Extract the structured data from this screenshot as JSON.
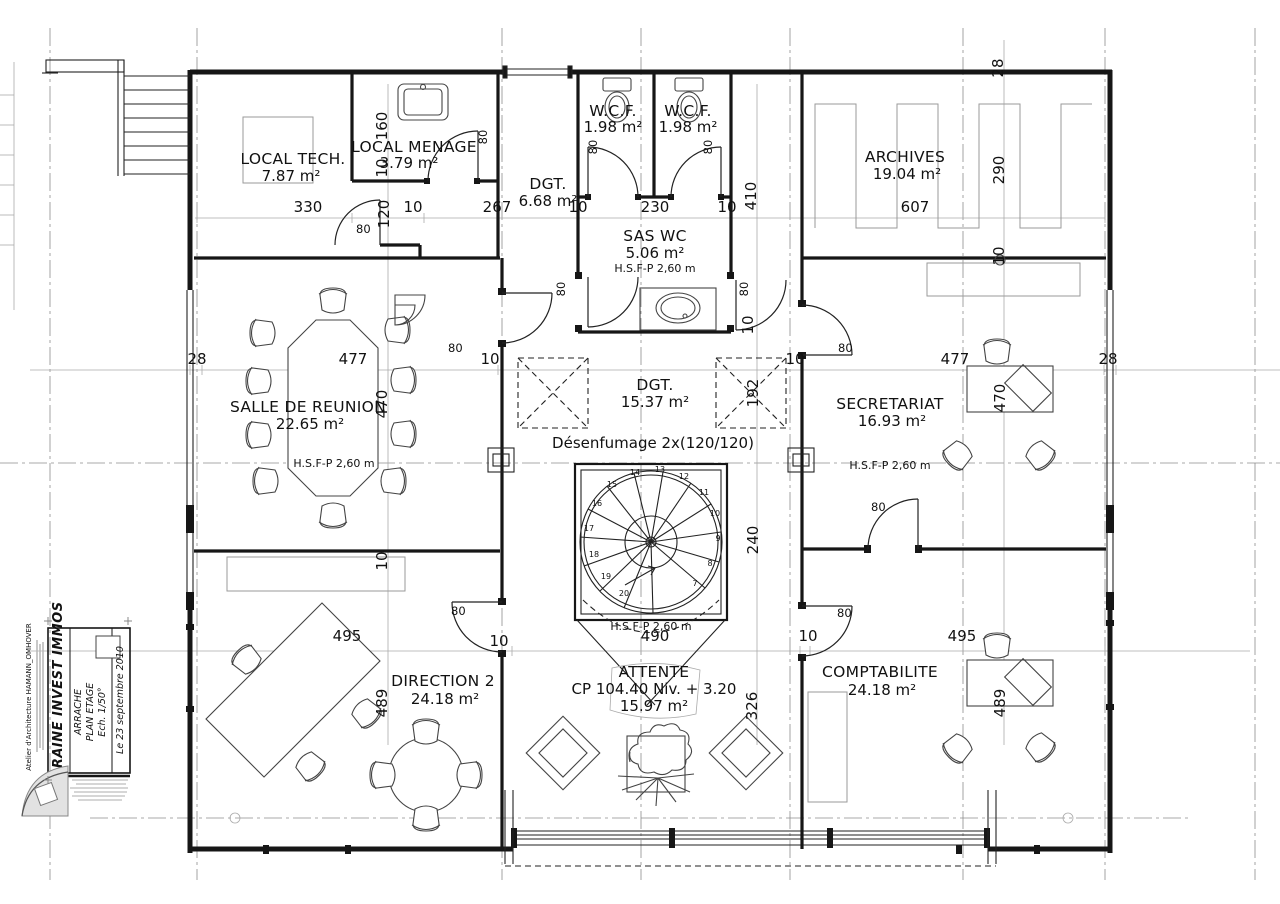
{
  "title_block": {
    "firm": "Atelier d'Architecture HAMANN_OMHOVER",
    "client": "LORRAINE INVEST IMMOS",
    "project": "ARRACHE",
    "sheet": "PLAN ETAGE",
    "scale": "Ech. 1/50°",
    "date": "Le 23 septembre 2010"
  },
  "rooms": {
    "local_tech": {
      "name": "LOCAL TECH.",
      "area": "7.87 m²"
    },
    "local_menage": {
      "name": "LOCAL MENAGE",
      "area": "3.79 m²"
    },
    "dgt_top": {
      "name": "DGT.",
      "area": "6.68 m²"
    },
    "wcf_left": {
      "name": "W.C.F.",
      "area": "1.98 m²"
    },
    "wcf_right": {
      "name": "W.C.F.",
      "area": "1.98 m²"
    },
    "archives": {
      "name": "ARCHIVES",
      "area": "19.04 m²"
    },
    "sas_wc": {
      "name": "SAS WC",
      "area": "5.06 m²",
      "height": "H.S.F-P 2,60 m"
    },
    "salle": {
      "name": "SALLE DE REUNION",
      "area": "22.65 m²",
      "height": "H.S.F-P 2,60 m"
    },
    "dgt_hall": {
      "name": "DGT.",
      "area": "15.37 m²"
    },
    "secretariat": {
      "name": "SECRETARIAT",
      "area": "16.93 m²",
      "height": "H.S.F-P 2,60 m"
    },
    "direction": {
      "name": "DIRECTION 2",
      "area": "24.18 m²"
    },
    "attente": {
      "name": "ATTENTE",
      "note": "CP 104.40 Niv. + 3.20",
      "area": "15.97 m²"
    },
    "comptabilite": {
      "name": "COMPTABILITE",
      "area": "24.18 m²"
    }
  },
  "annotations": {
    "desenfumage": "Désenfumage 2x(120/120)",
    "stair_hsfp": "H.S.F-P 2,60 m"
  },
  "stair": {
    "steps": [
      "7",
      "8",
      "9",
      "10",
      "11",
      "12",
      "13",
      "14",
      "15",
      "16",
      "17",
      "18",
      "19",
      "20"
    ]
  },
  "dims": {
    "d330": "330",
    "d120": "120",
    "t10": "10",
    "d267": "267",
    "d230": "230",
    "d410": "410",
    "d607": "607",
    "d28": "28",
    "d290": "290",
    "d160": "160",
    "d477": "477",
    "d470": "470",
    "d192": "192",
    "d240": "240",
    "d490": "490",
    "d495": "495",
    "d489": "489",
    "d326": "326",
    "d80": "80"
  }
}
